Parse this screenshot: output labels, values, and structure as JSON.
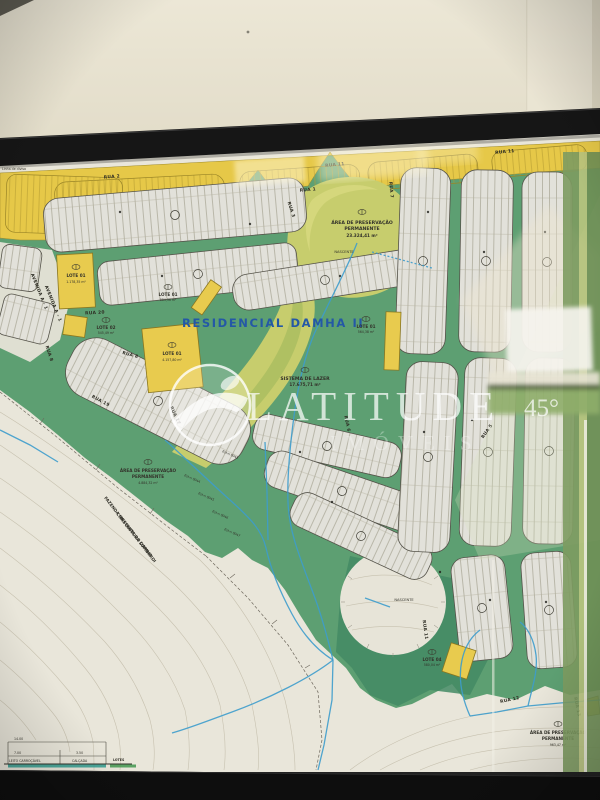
{
  "photo": {
    "wall_color": "#e9e4d2",
    "frame_color": "#141414"
  },
  "map": {
    "title": "RESIDENCIAL DAMHA II",
    "colors": {
      "green": "#5d9f72",
      "yellow_band": "#e6c848",
      "preservation_green": "#c7cd6d",
      "paper": "#e9e6da",
      "stream_blue": "#3d9ccc",
      "title_blue": "#2458a6"
    },
    "preservation_areas": [
      {
        "line1": "ÁREA DE PRESERVAÇÃO",
        "line2": "PERMANENTE",
        "area": "23.324,41 m²"
      },
      {
        "line1": "ÁREA DE PRESERVAÇÃO",
        "line2": "PERMANENTE",
        "area": "4.884,32 m²"
      },
      {
        "line1": "ÁREA DE PRESERVAÇÃO",
        "line2": "PERMANENTE",
        "area": "963,47 m²"
      }
    ],
    "leisure": {
      "label": "SISTEMA DE LAZER",
      "area": "17.675,71 m²"
    },
    "springs": {
      "top": "NASCENTE",
      "bottom": "NASCENTE"
    },
    "lots": [
      {
        "name": "LOTE 01",
        "area": "1.178,35 m²"
      },
      {
        "name": "LOTE 02",
        "area": "545,49 m²"
      },
      {
        "name": "LOTE 01",
        "area": "884,36 m²"
      },
      {
        "name": "LOTE 01",
        "area": "4.157,80 m²"
      },
      {
        "name": "LOTE 01",
        "area": "564,38 m²"
      },
      {
        "name": "LOTE 04",
        "area": "580,04 m²"
      }
    ],
    "streets": {
      "rua1": "RUA 1",
      "rua2": "RUA 2",
      "rua3": "RUA 3",
      "rua5": "RUA 5",
      "rua6": "RUA 6",
      "rua7": "RUA 7",
      "rua8": "RUA 8",
      "rua11": "RUA 11",
      "rua12": "RUA 12",
      "rua13": "RUA 13",
      "rua17": "RUA 17",
      "rua19": "RUA 19",
      "rua20": "RUA 20",
      "avenida": "AVENIDA A - 1"
    },
    "annotations": {
      "boundary": "Linha de divisa",
      "fazenda1": "FAZENDA MESQUITA DO DAMHA",
      "fazenda2": "CONSTRUTORA LOMBARDI",
      "est1": "Est-n 0043",
      "est2": "Est-n 0044",
      "est3": "Est-n 0045",
      "est4": "Est-n 0046",
      "est5": "Est-n 0047"
    },
    "section": {
      "total": "14.00",
      "road": "7.00",
      "walk": "3.50",
      "label_road": "LEITO CARROÇÁVEL",
      "label_walk": "CALÇADA",
      "label_lots": "LOTES"
    }
  },
  "watermark": {
    "brand": "LATITUDE",
    "degree": "45°",
    "line2": "IMÓVEIS"
  }
}
